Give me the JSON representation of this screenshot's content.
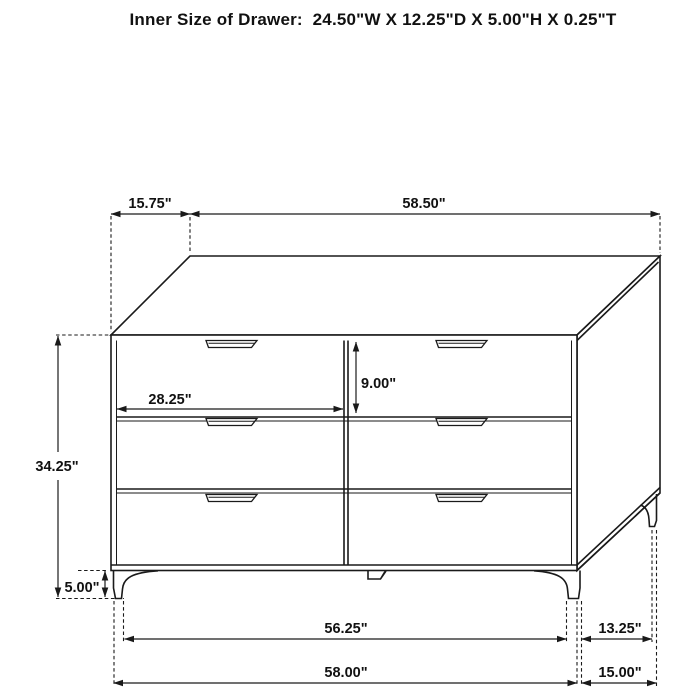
{
  "title": "Inner Size of Drawer:  24.50\"W X 12.25\"D X 5.00\"H X 0.25\"T",
  "diagram": {
    "type": "furniture-dimension-drawing",
    "object": "six-drawer dresser, three-quarter line view",
    "colors": {
      "line": "#1a1a1a",
      "background": "#ffffff",
      "text": "#111111"
    },
    "dimensions": {
      "top_depth_offset": "15.75\"",
      "top_width": "58.50\"",
      "overall_height": "34.25\"",
      "drawer_front_width": "28.25\"",
      "top_drawer_height": "9.00\"",
      "leg_height": "5.00\"",
      "front_leg_inner_span": "56.25\"",
      "side_leg_span": "13.25\"",
      "overall_width": "58.00\"",
      "overall_depth": "15.00\""
    }
  }
}
